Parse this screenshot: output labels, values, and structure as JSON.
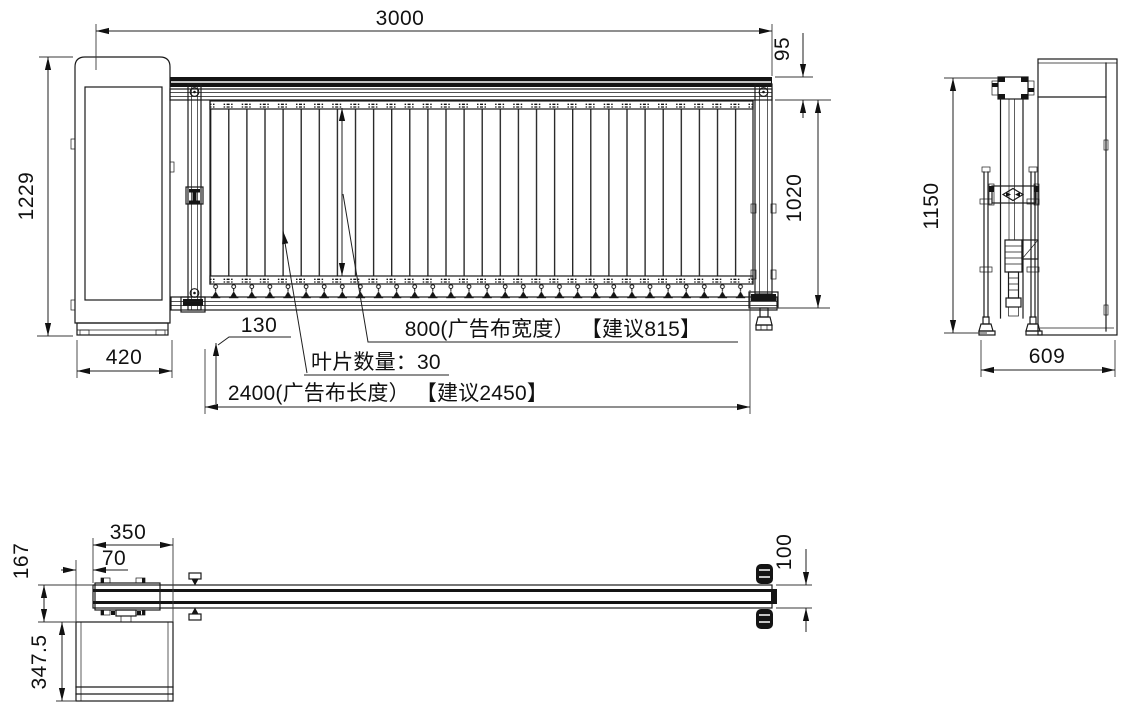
{
  "drawing": {
    "type": "barrier-gate-three-view-technical-drawing",
    "line_color": "#1a1a1a",
    "background": "#ffffff"
  },
  "front_view": {
    "dims": {
      "overall_length": "3000",
      "total_height": "1229",
      "boom_height": "95",
      "under_boom_height": "1020",
      "cabinet_width": "420",
      "skirt_ground_gap": "130",
      "banner_width_note": "800(广告布宽度） 【建议815】",
      "blade_count_note": "叶片数量：30",
      "banner_length_note": "2400(广告布长度） 【建议2450】"
    }
  },
  "side_view": {
    "dims": {
      "height": "1150",
      "depth": "609"
    }
  },
  "plan_view": {
    "dims": {
      "mount_length": "350",
      "boom_offset": "70",
      "boom_to_cabinet": "167",
      "cabinet_depth": "347.5",
      "boom_width": "100"
    }
  }
}
